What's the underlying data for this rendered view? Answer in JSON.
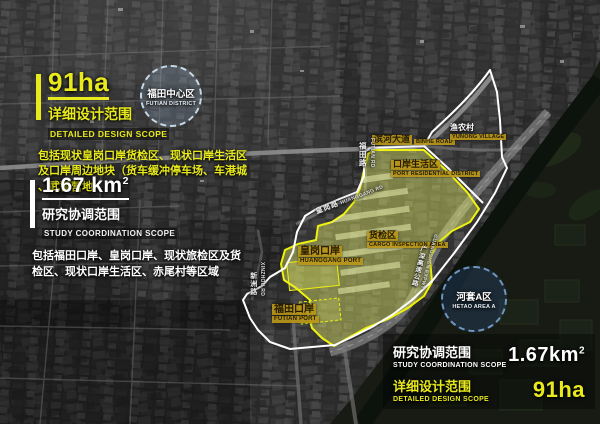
{
  "colors": {
    "accent_yellow": "#e8ea1c",
    "boundary_white": "#ffffff"
  },
  "panel_left": {
    "design": {
      "value": "91ha",
      "title_zh": "详细设计范围",
      "title_en": "DETAILED DESIGN SCOPE",
      "desc_line1": "包括现状皇岗口岸货检区、现状口岸生活区",
      "desc_line2": "及口岸周边地块（货车缓冲停车场、车港城",
      "desc_line3": "、武警营地）"
    },
    "study": {
      "value": "1.67 km",
      "value_sup": "2",
      "title_zh": "研究协调范围",
      "title_en": "STUDY COORDINATION SCOPE",
      "desc_line1": "包括福田口岸、皇岗口岸、现状旅检区及货",
      "desc_line2": "检区、现状口岸生活区、赤尾村等区域"
    }
  },
  "legend": {
    "study": {
      "title_zh": "研究协调范围",
      "title_en": "STUDY COORDINATION SCOPE",
      "value": "1.67km",
      "value_sup": "2"
    },
    "design": {
      "title_zh": "详细设计范围",
      "title_en": "DETAILED DESIGN SCOPE",
      "value": "91ha"
    }
  },
  "map": {
    "circle_futian": {
      "zh": "福田中心区",
      "en": "FUTIAN DISTRICT"
    },
    "circle_hetao": {
      "zh": "河套A区",
      "en": "HETAO AREA A"
    },
    "binhe": {
      "zh": "滨河大道",
      "en": "BINHE ROAD"
    },
    "futian_rd": {
      "zh": "福田路",
      "en": "FUTIAN RD"
    },
    "huanggang_rd": {
      "zh": "皇岗路",
      "en": "HUANGGANG RD"
    },
    "xinzhou_rd": {
      "zh": "新洲路",
      "en": "XINZHOU RD"
    },
    "gs_expwy": {
      "zh": "广深高速公路",
      "en": "GUANGSHEN EXPWY"
    },
    "yunong": {
      "zh": "渔农村",
      "en": "YUNONG VILLAGE"
    },
    "port_living": {
      "zh": "口岸生活区",
      "en": "PORT RESIDENTIAL DISTRICT"
    },
    "cargo": {
      "zh": "货检区",
      "en": "CARGO INSPECTION AREA"
    },
    "huanggang_port": {
      "zh": "皇岗口岸",
      "en": "HUANGGANG PORT"
    },
    "futian_port": {
      "zh": "福田口岸",
      "en": "FUTIAN PORT"
    }
  }
}
